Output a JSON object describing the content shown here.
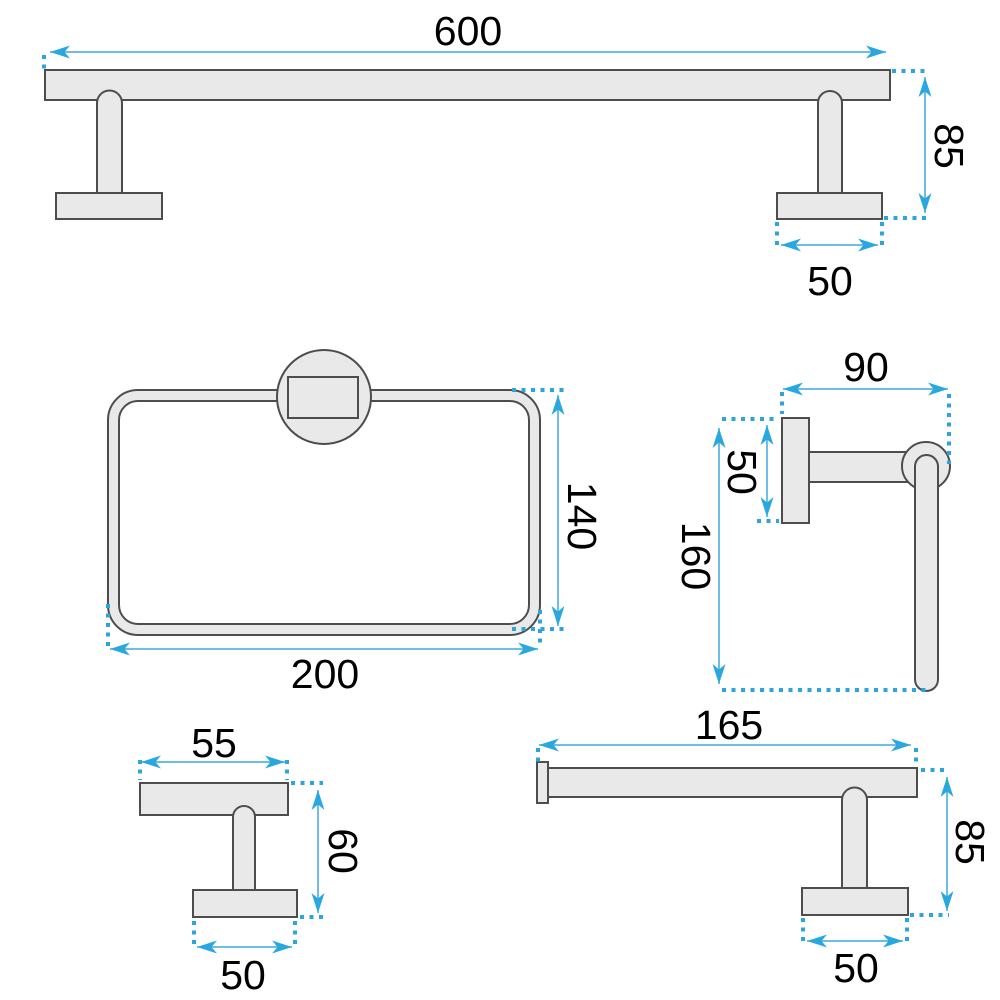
{
  "drawing": {
    "type": "technical-dimension-drawing",
    "subject": "bathroom accessories set",
    "background": "#FFFFFF",
    "colors": {
      "dimension_blue": "#29A8DF",
      "outline_gray": "#4D4D4D",
      "fill_gray": "#E9E9E9",
      "label_black": "#000000"
    },
    "items": [
      {
        "name": "towel-bar",
        "width": "600",
        "height": "85",
        "base_width": "50"
      },
      {
        "name": "towel-ring",
        "width": "200",
        "height": "140"
      },
      {
        "name": "wall-hook-side-view",
        "depth": "90",
        "plate_height": "50",
        "height": "160"
      },
      {
        "name": "robe-hook",
        "width": "55",
        "height": "60",
        "base_width": "50"
      },
      {
        "name": "toilet-paper-holder",
        "width": "165",
        "height": "85",
        "base_width": "50"
      }
    ]
  }
}
